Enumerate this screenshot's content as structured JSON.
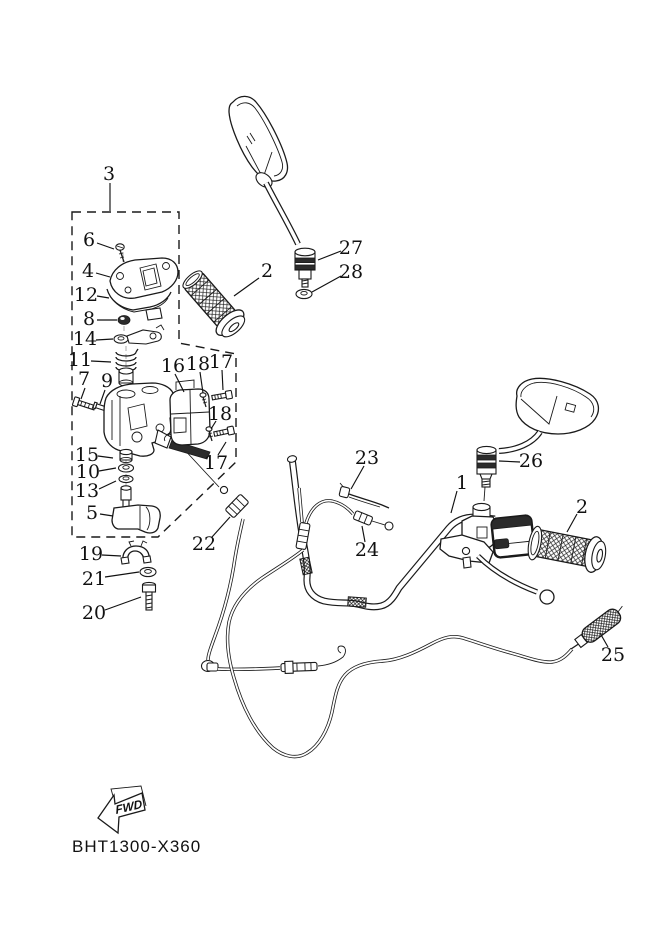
{
  "figure": {
    "footer_code": "BHT1300-X360",
    "fwd_label": "FWD",
    "background_color": "#ffffff",
    "line_color": "#1a1a1a",
    "type": "exploded-parts-diagram"
  },
  "callouts": [
    {
      "text": "1",
      "x": 462,
      "y": 483,
      "leader": [
        457,
        491,
        451,
        513
      ]
    },
    {
      "text": "2",
      "x": 267,
      "y": 271,
      "leader": [
        259,
        278,
        234,
        296
      ]
    },
    {
      "text": "2",
      "x": 582,
      "y": 507,
      "leader": [
        577,
        514,
        567,
        532
      ]
    },
    {
      "text": "3",
      "x": 109,
      "y": 174,
      "leader": [
        110,
        183,
        110,
        211
      ]
    },
    {
      "text": "4",
      "x": 88,
      "y": 271,
      "leader": [
        96,
        273,
        110,
        277
      ]
    },
    {
      "text": "5",
      "x": 92,
      "y": 513,
      "leader": [
        100,
        514,
        113,
        516
      ]
    },
    {
      "text": "6",
      "x": 89,
      "y": 240,
      "leader": [
        97,
        243,
        114,
        249
      ]
    },
    {
      "text": "7",
      "x": 84,
      "y": 379,
      "leader": [
        85,
        388,
        81,
        399
      ]
    },
    {
      "text": "8",
      "x": 89,
      "y": 319,
      "leader": [
        97,
        320,
        117,
        320
      ]
    },
    {
      "text": "9",
      "x": 107,
      "y": 381,
      "leader": [
        105,
        390,
        100,
        404
      ]
    },
    {
      "text": "10",
      "x": 88,
      "y": 472,
      "leader": [
        99,
        471,
        116,
        468
      ]
    },
    {
      "text": "11",
      "x": 80,
      "y": 360,
      "leader": [
        91,
        361,
        111,
        362
      ]
    },
    {
      "text": "12",
      "x": 86,
      "y": 295,
      "leader": [
        97,
        296,
        109,
        298
      ]
    },
    {
      "text": "13",
      "x": 87,
      "y": 491,
      "leader": [
        99,
        489,
        116,
        481
      ]
    },
    {
      "text": "14",
      "x": 85,
      "y": 339,
      "leader": [
        96,
        340,
        113,
        339
      ]
    },
    {
      "text": "15",
      "x": 87,
      "y": 455,
      "leader": [
        98,
        456,
        113,
        458
      ]
    },
    {
      "text": "16",
      "x": 173,
      "y": 366,
      "leader": [
        175,
        374,
        184,
        392
      ]
    },
    {
      "text": "17",
      "x": 221,
      "y": 362,
      "leader": [
        222,
        370,
        223,
        390
      ]
    },
    {
      "text": "17",
      "x": 216,
      "y": 463,
      "leader": [
        218,
        455,
        226,
        442
      ]
    },
    {
      "text": "18",
      "x": 198,
      "y": 364,
      "leader": [
        200,
        372,
        203,
        393
      ]
    },
    {
      "text": "18",
      "x": 220,
      "y": 414,
      "leader": [
        216,
        421,
        211,
        429
      ]
    },
    {
      "text": "19",
      "x": 91,
      "y": 554,
      "leader": [
        102,
        555,
        121,
        556
      ]
    },
    {
      "text": "20",
      "x": 94,
      "y": 613,
      "leader": [
        105,
        610,
        141,
        597
      ]
    },
    {
      "text": "21",
      "x": 94,
      "y": 579,
      "leader": [
        105,
        577,
        139,
        572
      ]
    },
    {
      "text": "22",
      "x": 204,
      "y": 544,
      "leader": [
        212,
        537,
        230,
        517
      ]
    },
    {
      "text": "23",
      "x": 367,
      "y": 458,
      "leader": [
        364,
        466,
        351,
        489
      ]
    },
    {
      "text": "24",
      "x": 367,
      "y": 550,
      "leader": [
        365,
        542,
        362,
        526
      ]
    },
    {
      "text": "25",
      "x": 613,
      "y": 655,
      "leader": [
        608,
        647,
        600,
        633
      ]
    },
    {
      "text": "26",
      "x": 531,
      "y": 461,
      "leader": [
        520,
        462,
        499,
        461
      ]
    },
    {
      "text": "27",
      "x": 351,
      "y": 248,
      "leader": [
        341,
        251,
        318,
        260
      ]
    },
    {
      "text": "28",
      "x": 351,
      "y": 272,
      "leader": [
        341,
        276,
        312,
        292
      ]
    }
  ]
}
